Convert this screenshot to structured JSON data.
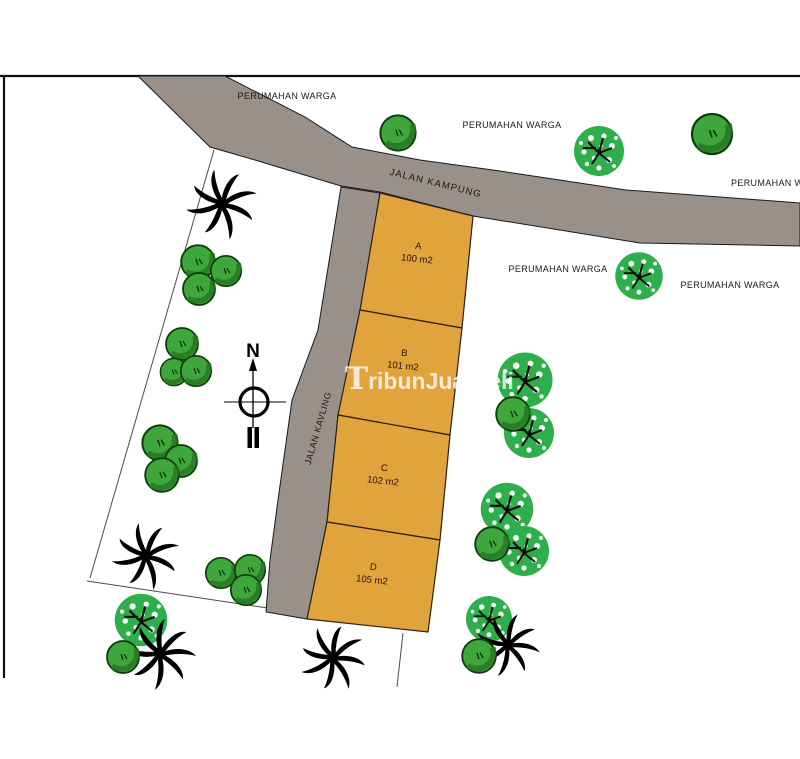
{
  "map": {
    "type": "site-plan",
    "colors": {
      "plot_fill": "#E1A33C",
      "road_fill": "#9A908A",
      "bush_green": "#3FA63B",
      "speckled_tree_green": "#2FAF4C",
      "palm_black": "#000000",
      "background": "#FFFFFF",
      "frame": "#111111"
    },
    "roads": [
      {
        "name": "JALAN KAMPUNG"
      },
      {
        "name": "JALAN KAVLING"
      }
    ],
    "plots": [
      {
        "id": "A",
        "area": "100 m2"
      },
      {
        "id": "B",
        "area": "101 m2"
      },
      {
        "id": "C",
        "area": "102 m2"
      },
      {
        "id": "D",
        "area": "105 m2"
      }
    ],
    "area_labels": [
      {
        "text": "PERUMAHAN WARGA"
      },
      {
        "text": "PERUMAHAN WARGA"
      },
      {
        "text": "PERUMAHAN WARGA"
      },
      {
        "text": "PERUMAHAN WARGA"
      },
      {
        "text": "PERUMAHAN WARGA"
      }
    ],
    "compass": {
      "north_label": "N"
    },
    "watermark": {
      "initial": "T",
      "rest": "ribunJualBeli"
    }
  }
}
